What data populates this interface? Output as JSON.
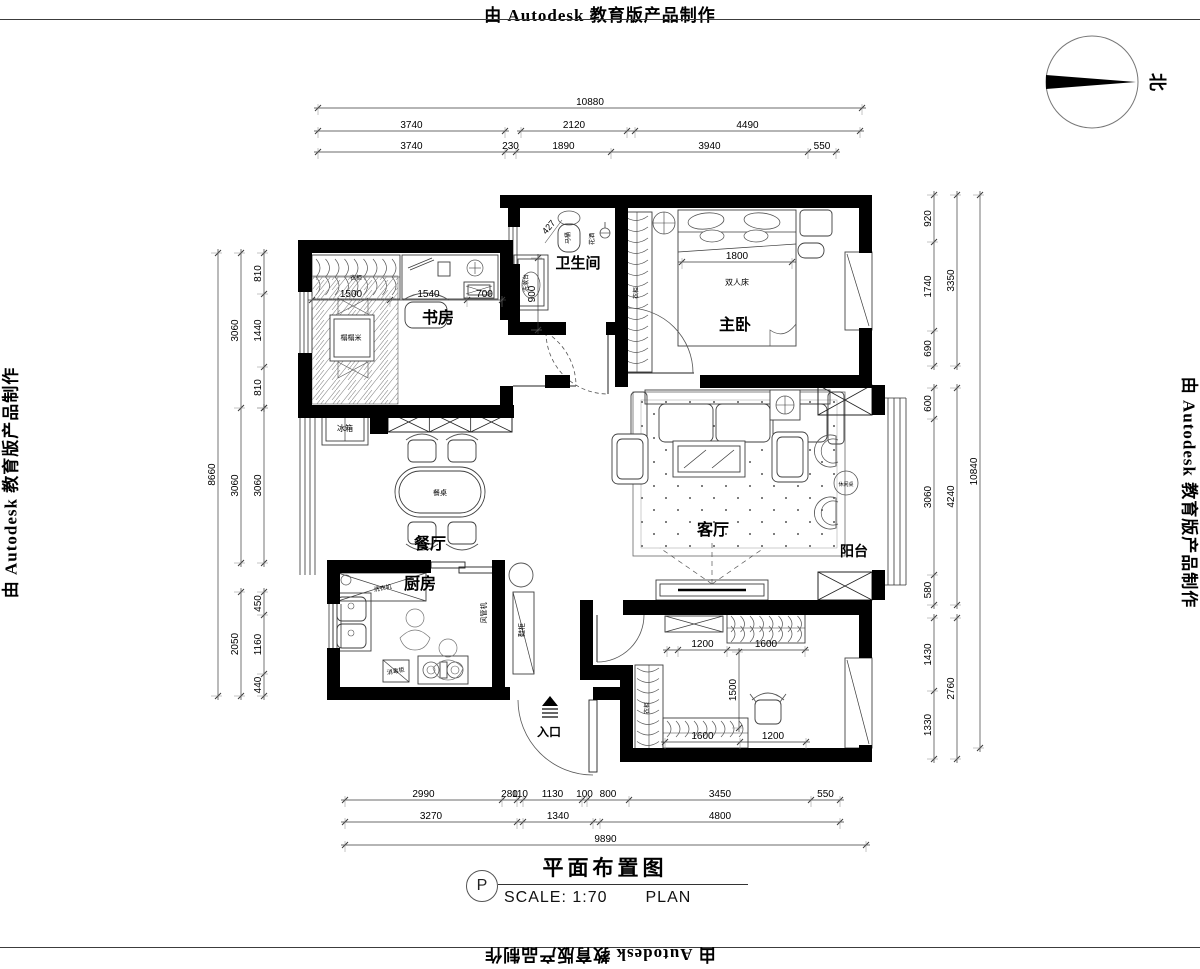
{
  "banners": {
    "text": "由 Autodesk 教育版产品制作"
  },
  "compass": {
    "north_label": "北"
  },
  "title_block": {
    "title": "平面布置图",
    "tag": "P",
    "scale_label": "SCALE: 1:70",
    "plan_label": "PLAN"
  },
  "colors": {
    "wall": "#000000",
    "furniture": "#3d3d3d",
    "dim": "#3a3a3a",
    "text": "#000000",
    "bg": "#ffffff"
  },
  "room_labels": [
    {
      "text": "卫生间",
      "x": 578,
      "y": 268,
      "size": 15
    },
    {
      "text": "书房",
      "x": 438,
      "y": 323,
      "size": 16
    },
    {
      "text": "主卧",
      "x": 735,
      "y": 330,
      "size": 16
    },
    {
      "text": "餐厅",
      "x": 430,
      "y": 549,
      "size": 16
    },
    {
      "text": "客厅",
      "x": 713,
      "y": 535,
      "size": 16
    },
    {
      "text": "阳台",
      "x": 854,
      "y": 556,
      "size": 14
    },
    {
      "text": "厨房",
      "x": 420,
      "y": 589,
      "size": 16
    },
    {
      "text": "入口",
      "x": 549,
      "y": 736,
      "size": 12
    }
  ],
  "annotation_labels": [
    {
      "text": "双人床",
      "x": 737,
      "y": 285,
      "size": 8,
      "rotate": 0
    },
    {
      "text": "马桶",
      "x": 570,
      "y": 238,
      "size": 6,
      "rotate": -90
    },
    {
      "text": "花洒",
      "x": 594,
      "y": 239,
      "size": 6,
      "rotate": -90
    },
    {
      "text": "洗漱台",
      "x": 528,
      "y": 283,
      "size": 6,
      "rotate": -90
    },
    {
      "text": "427",
      "x": 551,
      "y": 229,
      "size": 9,
      "rotate": -50
    },
    {
      "text": "榻榻米",
      "x": 351,
      "y": 340,
      "size": 7,
      "rotate": 0
    },
    {
      "text": "衣柜",
      "x": 356,
      "y": 280,
      "size": 6,
      "rotate": 0
    },
    {
      "text": "衣柜",
      "x": 638,
      "y": 293,
      "size": 6,
      "rotate": -90
    },
    {
      "text": "衣柜",
      "x": 649,
      "y": 708,
      "size": 6,
      "rotate": -90
    },
    {
      "text": "冰箱",
      "x": 345,
      "y": 431,
      "size": 8,
      "rotate": 0
    },
    {
      "text": "餐桌",
      "x": 440,
      "y": 495,
      "size": 7,
      "rotate": 0
    },
    {
      "text": "洗衣机",
      "x": 383,
      "y": 590,
      "size": 6,
      "rotate": -10
    },
    {
      "text": "消毒柜",
      "x": 396,
      "y": 673,
      "size": 6,
      "rotate": -10
    },
    {
      "text": "风管机",
      "x": 486,
      "y": 613,
      "size": 7,
      "rotate": -90
    },
    {
      "text": "鞋柜",
      "x": 524,
      "y": 630,
      "size": 7,
      "rotate": -90
    },
    {
      "text": "休闲桌",
      "x": 846,
      "y": 486,
      "size": 5,
      "rotate": 0
    }
  ],
  "dimensions": {
    "horizontal": [
      {
        "name": "top-total",
        "y": 108,
        "ticks": [
          318,
          862
        ],
        "labels": [
          "10880"
        ]
      },
      {
        "name": "top-row2-a",
        "y": 131,
        "ticks": [
          318,
          505
        ],
        "labels": [
          "3740"
        ]
      },
      {
        "name": "top-row2-b",
        "y": 131,
        "ticks": [
          521,
          627
        ],
        "labels": [
          "2120"
        ]
      },
      {
        "name": "top-row2-c",
        "y": 131,
        "ticks": [
          635,
          860
        ],
        "labels": [
          "4490"
        ]
      },
      {
        "name": "top-row3",
        "y": 152,
        "ticks": [
          318,
          505,
          516,
          611,
          808,
          836
        ],
        "labels": [
          "3740",
          "230",
          "1890",
          "3940",
          "550"
        ]
      },
      {
        "name": "bottom-row1",
        "y": 800,
        "ticks": [
          345,
          502,
          517,
          523,
          582,
          587,
          629,
          811,
          840
        ],
        "labels": [
          "2990",
          "280",
          "110",
          "1130",
          "100",
          "800",
          "3450",
          "550"
        ]
      },
      {
        "name": "bottom-row2-a",
        "y": 822,
        "ticks": [
          345,
          517
        ],
        "labels": [
          "3270"
        ]
      },
      {
        "name": "bottom-row2-b",
        "y": 822,
        "ticks": [
          523,
          593
        ],
        "labels": [
          "1340"
        ]
      },
      {
        "name": "bottom-row2-c",
        "y": 822,
        "ticks": [
          600,
          840
        ],
        "labels": [
          "4800"
        ]
      },
      {
        "name": "bottom-total",
        "y": 845,
        "ticks": [
          345,
          866
        ],
        "labels": [
          "9890"
        ]
      },
      {
        "name": "study-interior",
        "y": 300,
        "ticks": [
          312,
          390,
          467,
          502
        ],
        "labels": [
          "1500",
          "1540",
          "700"
        ]
      },
      {
        "name": "bed-width",
        "y": 262,
        "ticks": [
          682,
          792
        ],
        "labels": [
          "1800"
        ]
      },
      {
        "name": "room2-top",
        "y": 650,
        "ticks": [
          667,
          678,
          727,
          805
        ],
        "labels": [
          "",
          "1200",
          "1600"
        ]
      },
      {
        "name": "room2-bottom",
        "y": 742,
        "ticks": [
          665,
          740,
          806
        ],
        "labels": [
          "1600",
          "1200"
        ]
      }
    ],
    "vertical": [
      {
        "name": "left-total",
        "x": 218,
        "ticks": [
          253,
          696
        ],
        "labels": [
          "8660"
        ]
      },
      {
        "name": "left-mid-a",
        "x": 241,
        "ticks": [
          253,
          408,
          563
        ],
        "labels": [
          "3060",
          "3060"
        ]
      },
      {
        "name": "left-mid-b",
        "x": 241,
        "ticks": [
          592,
          696
        ],
        "labels": [
          "2050"
        ]
      },
      {
        "name": "left-inner-a",
        "x": 264,
        "ticks": [
          253,
          294,
          367,
          408
        ],
        "labels": [
          "810",
          "1440",
          "810"
        ]
      },
      {
        "name": "left-inner-b",
        "x": 264,
        "ticks": [
          408,
          563
        ],
        "labels": [
          "3060"
        ]
      },
      {
        "name": "left-inner-c",
        "x": 264,
        "ticks": [
          592,
          615,
          674,
          696
        ],
        "labels": [
          "450",
          "1160",
          "440"
        ]
      },
      {
        "name": "right-inner-a",
        "x": 934,
        "ticks": [
          195,
          242,
          331,
          366
        ],
        "labels": [
          "920",
          "1740",
          "690"
        ]
      },
      {
        "name": "right-inner-b",
        "x": 934,
        "ticks": [
          388,
          419,
          575,
          605
        ],
        "labels": [
          "600",
          "3060",
          "580"
        ]
      },
      {
        "name": "right-inner-c",
        "x": 934,
        "ticks": [
          618,
          691,
          759
        ],
        "labels": [
          "1430",
          "1330"
        ]
      },
      {
        "name": "right-mid-a",
        "x": 957,
        "ticks": [
          195,
          366
        ],
        "labels": [
          "3350"
        ]
      },
      {
        "name": "right-mid-b",
        "x": 957,
        "ticks": [
          388,
          605
        ],
        "labels": [
          "4240"
        ]
      },
      {
        "name": "right-mid-c",
        "x": 957,
        "ticks": [
          618,
          759
        ],
        "labels": [
          "2760"
        ]
      },
      {
        "name": "right-total",
        "x": 980,
        "ticks": [
          195,
          748
        ],
        "labels": [
          "10840"
        ]
      },
      {
        "name": "bath-depth",
        "x": 538,
        "ticks": [
          258,
          330
        ],
        "labels": [
          "900"
        ]
      },
      {
        "name": "room2-depth",
        "x": 739,
        "ticks": [
          652,
          728
        ],
        "labels": [
          "1500"
        ]
      }
    ]
  }
}
